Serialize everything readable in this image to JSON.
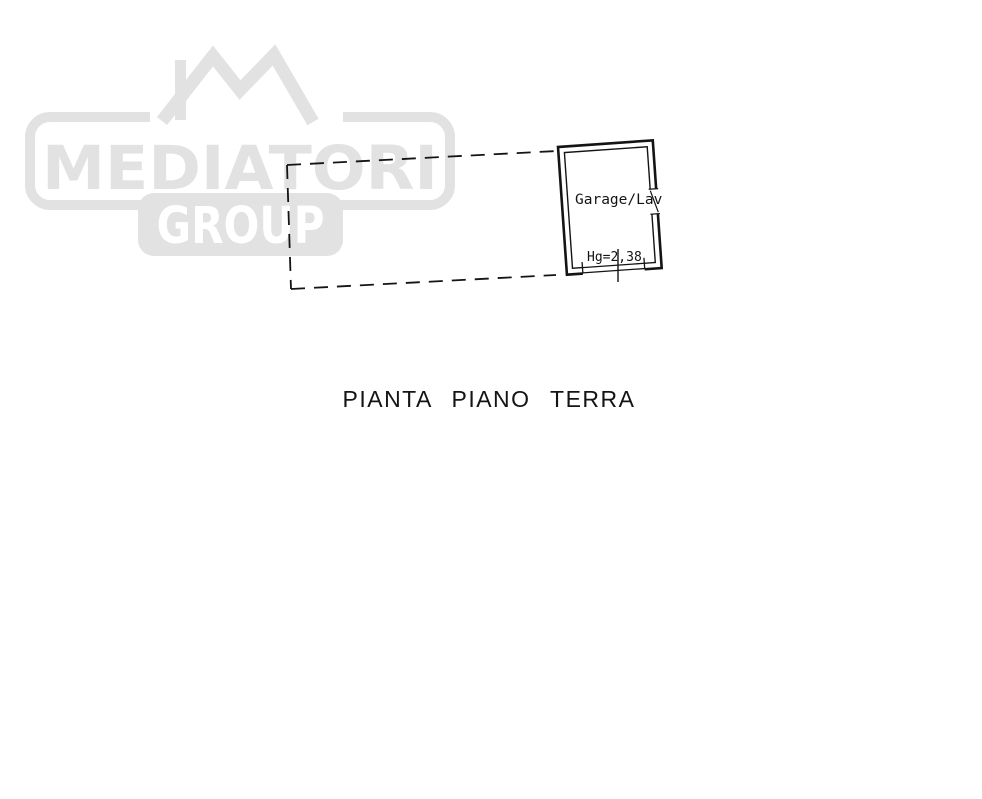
{
  "colors": {
    "watermark": "#e2e2e2",
    "ink": "#141414",
    "background": "#ffffff"
  },
  "watermark": {
    "brand_top": "MEDIATORI",
    "brand_bottom": "GROUP",
    "logo_icon": "mountain-peaks-icon"
  },
  "plan": {
    "room_label": "Garage/Lav",
    "height_label": "Hg=2,38",
    "title": "PIANTA PIANO TERRA"
  }
}
